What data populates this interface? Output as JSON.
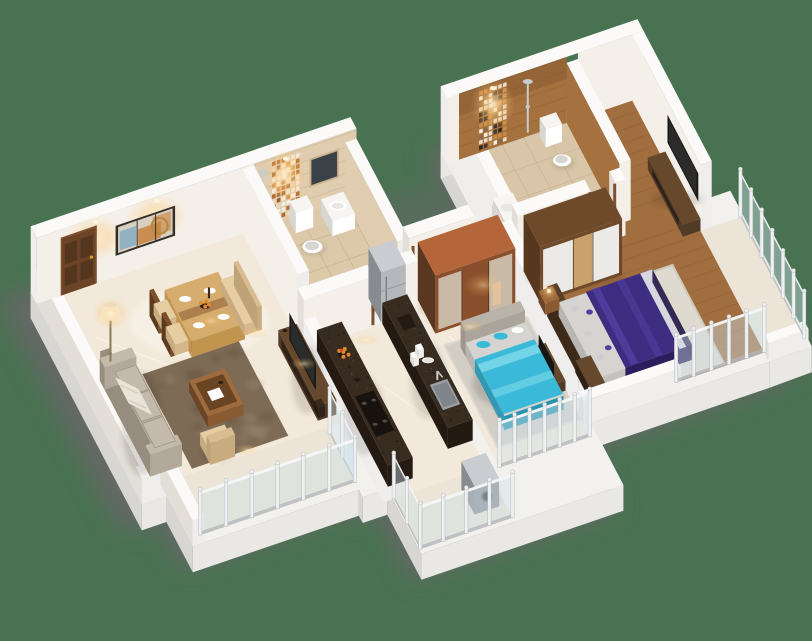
{
  "scene": {
    "kind": "isometric-3d-floorplan-render",
    "description": "Cutaway 3D render of a 2BHK apartment: living-dining with sofa and TV unit, common bathroom, kitchen with parallel granite counters, two bedrooms (purple bed, cyan bed), master bathroom, and glass-railing balconies",
    "visible_text": ""
  },
  "palette": {
    "bg": "#487251",
    "shadowGray": "#676767",
    "slab": "#f3f1ee",
    "slabSouth": "#eae8e4",
    "slabWest": "#d8d6d2",
    "wallTop": "#fbfaf8",
    "wallCream1": "#f4f0e9",
    "wallCream2": "#e2dcd2",
    "wallWhiteFace": "#efeeec",
    "wallWestShade": "#e3dfd8",
    "wallInnerShade": "#d6d1ca",
    "floorMarble1": "#f2e9da",
    "floorMarble2": "#e6d9c5",
    "floorLight": "#ece4d6",
    "floorCorridor": "#eee6d7",
    "tileBeige1": "#e0cdb0",
    "tileBeige2": "#cbb38f",
    "bathFloor": "#dcc9aa",
    "groutBeige": "#c2ab89",
    "tileBrown1": "#a4713f",
    "tileBrown2": "#7a4c27",
    "bathFloor2": "#d9c6a8",
    "groutBrown": "#8a5e35",
    "woodFloor1": "#a06e3f",
    "woodFloor2": "#8a5a30",
    "doorWood": "#6b4428",
    "doorWoodDark": "#54351e",
    "frameWood": "#7c5030",
    "paintFrame": "#332e28",
    "artBg": "#d9cfc0",
    "artOrange": "#c8823c",
    "artBlue": "#7fa9c2",
    "artGold": "#b8893c",
    "wardrobeFrame": "#6e4a2b",
    "wardrobeWhite": "#eceae6",
    "wardrobeWood": "#c9a26b",
    "wardrobeSide": "#57381f",
    "ward2Top": "#b5653a",
    "ward2Frame": "#8a4f2c",
    "ward2Glass": "#cfc5b4",
    "ward2Glow": "#e8c49a",
    "ward2Side": "#5a3720",
    "graniteTop": "#382b20",
    "graniteSpeck1": "#5c4a36",
    "graniteSpeck2": "#16100c",
    "counterBase": "#efe9df",
    "counterSide": "#dcd4c7",
    "fridge1": "#b4b7bc",
    "fridge2": "#888b90",
    "fridgeTop": "#c9ccd0",
    "sofaBase": "#b3a99b",
    "sofaDark": "#978d7f",
    "sofaCushion": "#c4baac",
    "sofaThrow": "#e9e3d8",
    "rugBrown1": "#7e6b56",
    "rugBrown2": "#665540",
    "rugBrown3": "#93846d",
    "rugGray": "#d2cec6",
    "rugWhite": "#dfdacf",
    "tableWood": "#d6ad6e",
    "tableSide": "#c2954f",
    "legDark": "#3a3a3a",
    "chairWood": "#7c4e2a",
    "cushion": "#e6cda2",
    "benchBack": "#d9bd92",
    "tvBlack": "#161616",
    "tvScreen": "#2b2b2b",
    "tvUnitWood": "#523b26",
    "tvUnitTop": "#66492d",
    "coffeeWood": "#8a5a32",
    "coffeeTop": "#9d6b3d",
    "bedPurple1": "#3c2d80",
    "bedPurple2": "#2a1f5c",
    "bedPurpleHi": "#5140a0",
    "mattress": "#d6d4d0",
    "pillowGray": "#cfcdd2",
    "headboard1": "#5a3f28",
    "sheetFoot": "#d8d6de",
    "bedCyan1": "#3ab9d8",
    "bedCyan2": "#2795b1",
    "bedCyanHi": "#74d4e8",
    "headboard2": "#b9b3a9",
    "glass": "#cfe2ea",
    "post": "#eef0f2",
    "postEdge": "#b6babe",
    "rail": "#f4f5f6",
    "chrome": "#c7ccd1",
    "porcelain": "#f6f5f2",
    "porcelainShade": "#d8d6d2",
    "mirrorDark": "#3a4248",
    "applianceGray": "#8f9296",
    "applianceDark": "#6d7074",
    "sinkSteel": "#9aa0a5",
    "sinkInner": "#7f858a",
    "glowWarm": "#ffd9a6",
    "glowHot": "#fff3d8",
    "orange": "#e08a2e",
    "orangeRed": "#cc5522",
    "bowlDark": "#241a12",
    "mosaicBeige": [
      "#d98e3f",
      "#f3ece0",
      "#9c5f2e",
      "#e8d9c0",
      "#b06a2f",
      "#f8f2e6"
    ],
    "mosaicDark": [
      "#2e2620",
      "#e8dcc8",
      "#8a6a48",
      "#f5efe2",
      "#c98a44",
      "#4a3a2c"
    ]
  },
  "rooms": [
    {
      "name": "living-dining",
      "floor": "marble",
      "furniture": [
        "entrance-door",
        "wall-art",
        "dining-table",
        "dining-chairs",
        "dining-bench",
        "sofa",
        "floor-lamp",
        "area-rug",
        "coffee-table",
        "armchair",
        "tv-unit",
        "television"
      ]
    },
    {
      "name": "common-bathroom",
      "floor": "beige-tile",
      "furniture": [
        "shower",
        "mosaic-tile-strip",
        "mirror",
        "wash-basin",
        "toilet"
      ]
    },
    {
      "name": "kitchen",
      "floor": "marble",
      "furniture": [
        "hob-counter",
        "sink-counter",
        "refrigerator",
        "fruit-bowl",
        "sink",
        "plates"
      ]
    },
    {
      "name": "living-balcony",
      "floor": "marble",
      "furniture": [
        "glass-railing"
      ]
    },
    {
      "name": "utility-balcony",
      "floor": "marble",
      "furniture": [
        "glass-railing",
        "washing-machine"
      ]
    },
    {
      "name": "bedroom-2",
      "floor": "marble",
      "furniture": [
        "bed-cyan",
        "wardrobe-sliding-glass",
        "rug",
        "glass-railing",
        "tv-console"
      ]
    },
    {
      "name": "master-bedroom",
      "floor": "wood-plank",
      "furniture": [
        "bed-purple",
        "wardrobe-sliding-white",
        "tv-console",
        "television",
        "rug",
        "nightstand",
        "dresser",
        "balcony-glass-railing"
      ]
    },
    {
      "name": "master-bathroom",
      "floor": "beige-tile",
      "furniture": [
        "shower",
        "mosaic-tile-strip",
        "toilet",
        "wash-basin"
      ]
    }
  ]
}
